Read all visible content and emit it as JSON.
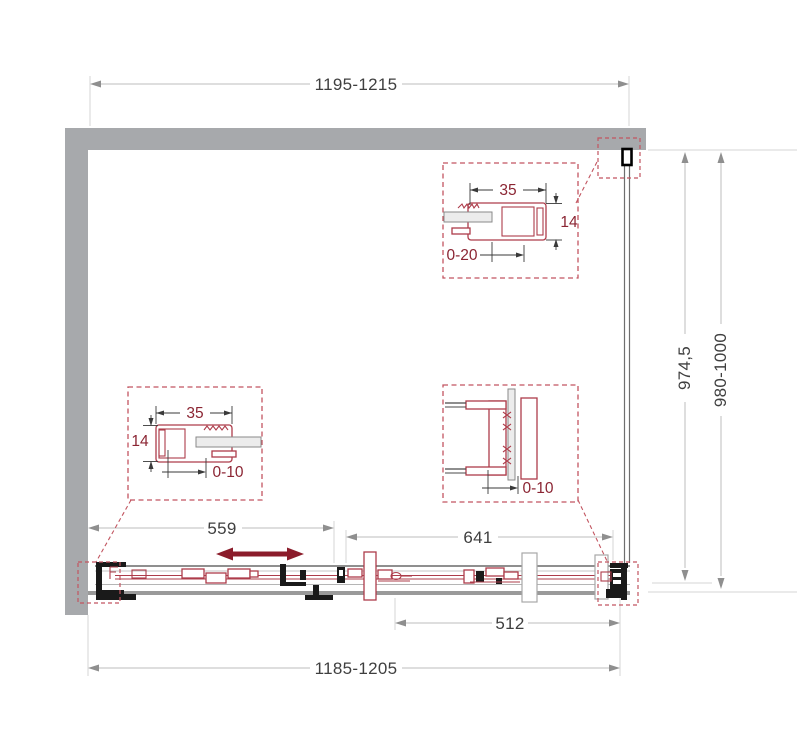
{
  "colors": {
    "wall": "#a7a9ac",
    "glass": "#ececec",
    "dimline": "#bdbdbd",
    "extline": "#d4d4d4",
    "arrow": "#8f8f8f",
    "dimtext": "#3f3f3f",
    "maroon": "#8b1c2b",
    "detailtext": "#8b2533",
    "profile": "#ad3c4a",
    "dash": "#c25560",
    "dark": "#1a1a1a"
  },
  "dimensions": {
    "top_width": "1195-1215",
    "bottom_width": "1185-1205",
    "side_inner": "974,5",
    "side_range": "980-1000",
    "left_segment": "559",
    "door_segment": "641",
    "glass_segment": "512"
  },
  "details": {
    "top_wall_profile": {
      "width": "35",
      "thickness": "14",
      "adjustment": "0-20"
    },
    "left_wall_profile": {
      "width": "35",
      "thickness": "14",
      "adjustment": "0-10"
    },
    "panel_overlap": {
      "adjustment": "0-10"
    }
  }
}
